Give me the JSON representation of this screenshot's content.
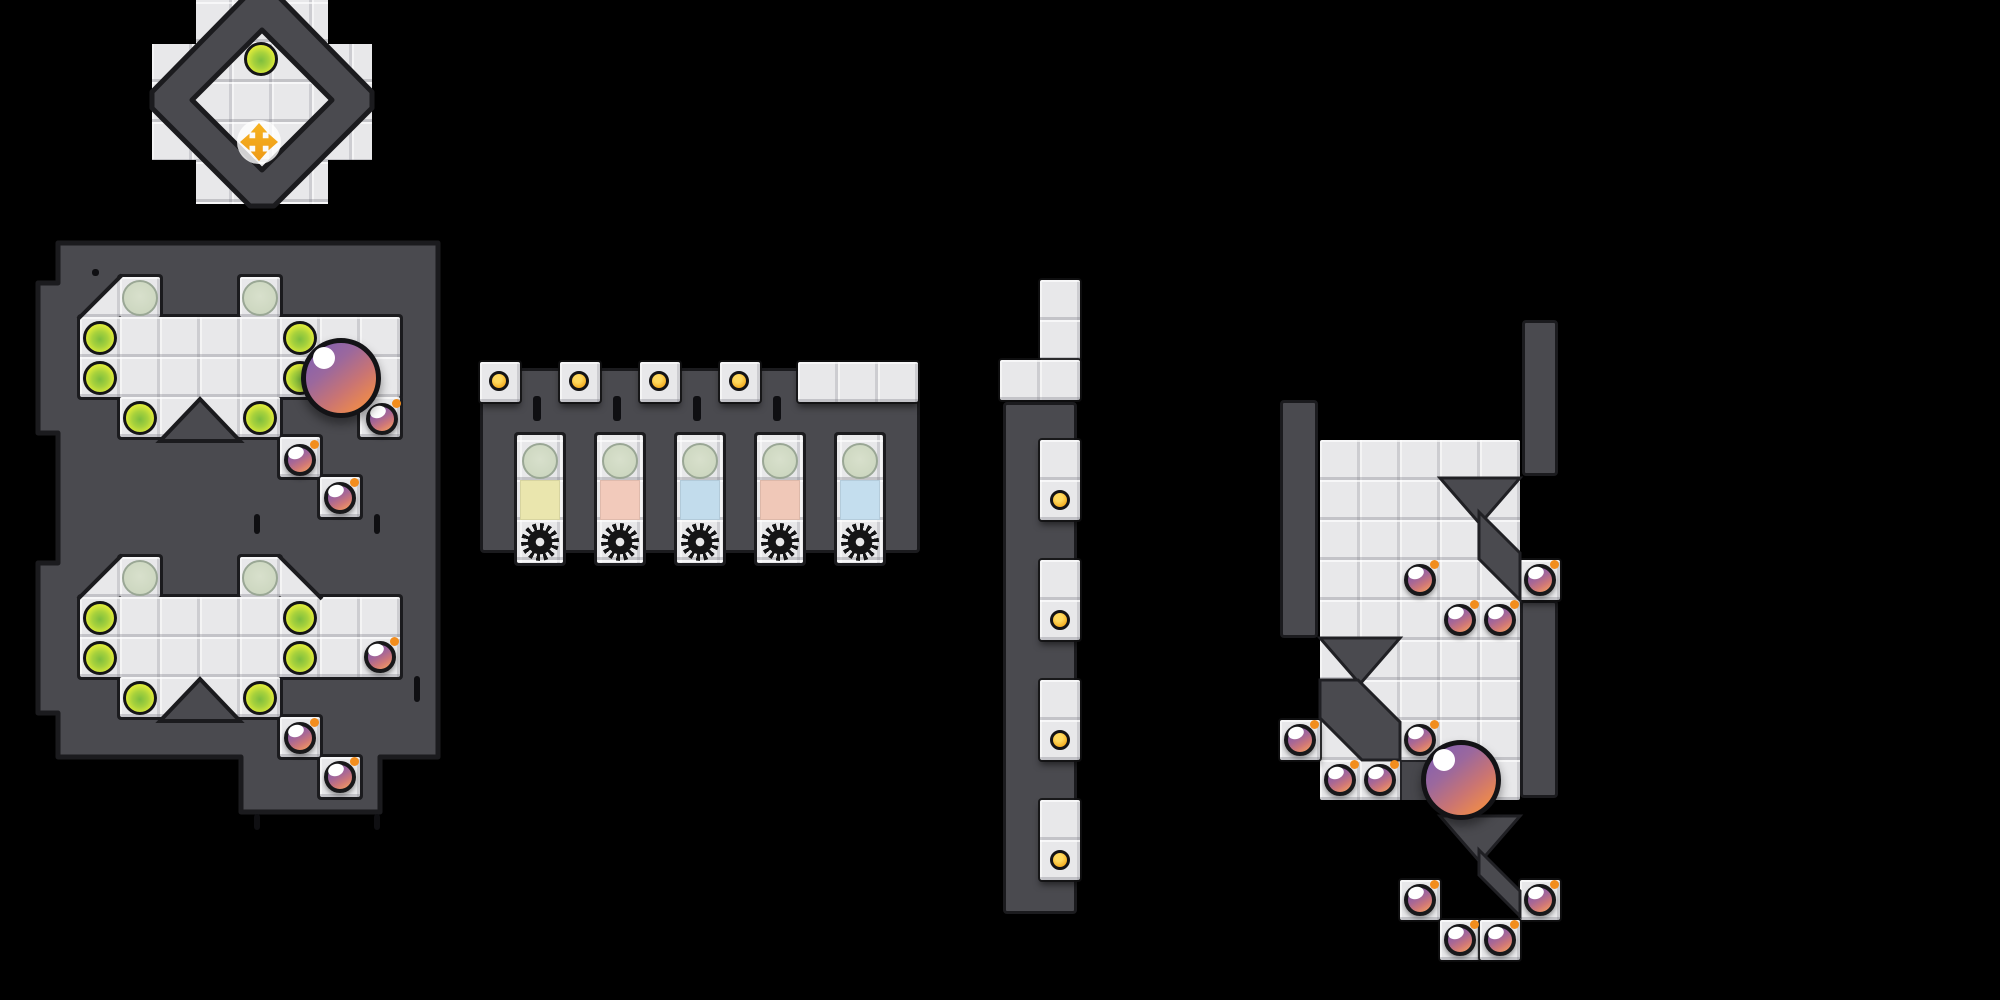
{
  "palette": {
    "background": "#000000",
    "wall": "#4a4a4f",
    "wall_outline": "#1b1b1e",
    "floor": "#e8e8ea",
    "green_orb": "#dcea3a",
    "ghost_orb": "#cfd9c4",
    "bomb_purple": "#8a5fa9",
    "bomb_orange": "#f09a62",
    "bomb_fuse": "#f28d1d",
    "sphere_purple": "#8a62ab",
    "sphere_orange": "#ef8b49",
    "dot_yellow": "#f3a81b",
    "cross_orange": "#f2a51f",
    "gear_black": "#141416",
    "slot_window_colors": [
      "#eae6ae",
      "#f2cabb",
      "#c2dcec",
      "#f0c8b8",
      "#c4deee"
    ]
  },
  "structures": {
    "diamond_room": {
      "entities": [
        {
          "t": "orb-green",
          "x": 261,
          "y": 59
        },
        {
          "t": "move-cross",
          "x": 259,
          "y": 142
        }
      ]
    },
    "west_map": {
      "entities": [
        {
          "t": "orb-ghost",
          "x": 140,
          "y": 298
        },
        {
          "t": "orb-ghost",
          "x": 260,
          "y": 298
        },
        {
          "t": "orb-ghost",
          "x": 140,
          "y": 578
        },
        {
          "t": "orb-ghost",
          "x": 260,
          "y": 578
        },
        {
          "t": "orb-green",
          "x": 100,
          "y": 338
        },
        {
          "t": "orb-green",
          "x": 100,
          "y": 378
        },
        {
          "t": "orb-green",
          "x": 300,
          "y": 338
        },
        {
          "t": "orb-green",
          "x": 300,
          "y": 378
        },
        {
          "t": "orb-green",
          "x": 140,
          "y": 418
        },
        {
          "t": "orb-green",
          "x": 260,
          "y": 418
        },
        {
          "t": "orb-green",
          "x": 100,
          "y": 618
        },
        {
          "t": "orb-green",
          "x": 100,
          "y": 658
        },
        {
          "t": "orb-green",
          "x": 300,
          "y": 618
        },
        {
          "t": "orb-green",
          "x": 300,
          "y": 658
        },
        {
          "t": "orb-green",
          "x": 140,
          "y": 698
        },
        {
          "t": "orb-green",
          "x": 260,
          "y": 698
        },
        {
          "t": "bomb",
          "x": 382,
          "y": 419
        },
        {
          "t": "bomb",
          "x": 300,
          "y": 460
        },
        {
          "t": "bomb",
          "x": 340,
          "y": 498
        },
        {
          "t": "bomb",
          "x": 380,
          "y": 657
        },
        {
          "t": "bomb",
          "x": 300,
          "y": 738
        },
        {
          "t": "bomb",
          "x": 340,
          "y": 777
        },
        {
          "t": "sphere",
          "x": 341,
          "y": 378
        }
      ]
    },
    "slot_machine": {
      "entities": [
        {
          "t": "dot",
          "x": 499,
          "y": 381
        },
        {
          "t": "dot",
          "x": 579,
          "y": 381
        },
        {
          "t": "dot",
          "x": 659,
          "y": 381
        },
        {
          "t": "dot",
          "x": 739,
          "y": 381
        },
        {
          "t": "orb-ghost",
          "x": 540,
          "y": 461
        },
        {
          "t": "orb-ghost",
          "x": 620,
          "y": 461
        },
        {
          "t": "orb-ghost",
          "x": 700,
          "y": 461
        },
        {
          "t": "orb-ghost",
          "x": 780,
          "y": 461
        },
        {
          "t": "orb-ghost",
          "x": 860,
          "y": 461
        },
        {
          "t": "slot-square",
          "x": 540,
          "y": 500,
          "c": "#eae6ae"
        },
        {
          "t": "slot-square",
          "x": 620,
          "y": 500,
          "c": "#f2cabb"
        },
        {
          "t": "slot-square",
          "x": 700,
          "y": 500,
          "c": "#c2dcec"
        },
        {
          "t": "slot-square",
          "x": 780,
          "y": 500,
          "c": "#f0c8b8"
        },
        {
          "t": "slot-square",
          "x": 860,
          "y": 500,
          "c": "#c4deee"
        },
        {
          "t": "gear",
          "x": 540,
          "y": 542
        },
        {
          "t": "gear",
          "x": 620,
          "y": 542
        },
        {
          "t": "gear",
          "x": 700,
          "y": 542
        },
        {
          "t": "gear",
          "x": 780,
          "y": 542
        },
        {
          "t": "gear",
          "x": 860,
          "y": 542
        }
      ]
    },
    "dot_corridor": {
      "entities": [
        {
          "t": "dot",
          "x": 1060,
          "y": 500
        },
        {
          "t": "dot",
          "x": 1060,
          "y": 620
        },
        {
          "t": "dot",
          "x": 1060,
          "y": 740
        },
        {
          "t": "dot",
          "x": 1060,
          "y": 860
        }
      ]
    },
    "east_map": {
      "entities": [
        {
          "t": "bomb",
          "x": 1420,
          "y": 580
        },
        {
          "t": "bomb",
          "x": 1460,
          "y": 620
        },
        {
          "t": "bomb",
          "x": 1500,
          "y": 620
        },
        {
          "t": "bomb",
          "x": 1540,
          "y": 580
        },
        {
          "t": "bomb",
          "x": 1300,
          "y": 740
        },
        {
          "t": "bomb",
          "x": 1420,
          "y": 740
        },
        {
          "t": "bomb",
          "x": 1340,
          "y": 780
        },
        {
          "t": "bomb",
          "x": 1380,
          "y": 780
        },
        {
          "t": "bomb",
          "x": 1420,
          "y": 900
        },
        {
          "t": "bomb",
          "x": 1540,
          "y": 900
        },
        {
          "t": "bomb",
          "x": 1460,
          "y": 940
        },
        {
          "t": "bomb",
          "x": 1500,
          "y": 940
        },
        {
          "t": "sphere",
          "x": 1461,
          "y": 780
        }
      ]
    }
  }
}
